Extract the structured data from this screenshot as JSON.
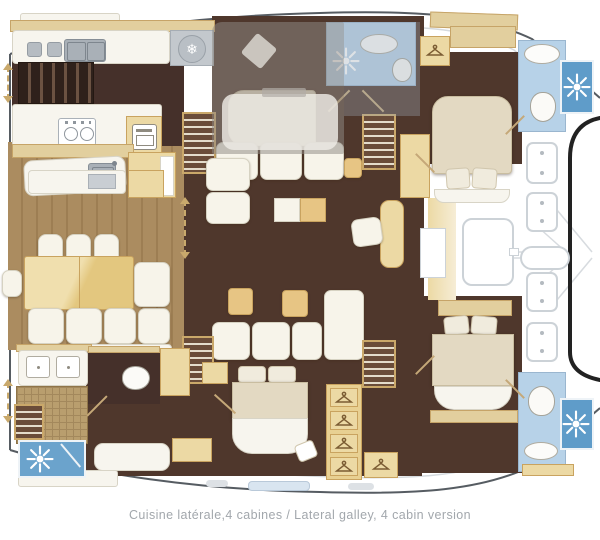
{
  "caption": {
    "text": "Cuisine latérale,4 cabines / Lateral galley, 4 cabin version"
  },
  "colors": {
    "hull_line": "#4a5055",
    "deck_line": "#c9ced3",
    "wood_floor": "#aa8b5e",
    "cabin_floor": "#4f372c",
    "cabinet_tan": "#ecd9a4",
    "bed_cream": "#e3d9c2",
    "white_furniture": "#f7f4ea",
    "bathroom_blue": "#b7d2e8",
    "shower_blue": "#5f9cc9",
    "flybridge_overlay_gray": "#8f8b85",
    "caption_text": "#a2a7ac"
  },
  "icons": {
    "fridge": {
      "name": "snowflake-icon",
      "glyph": "❄"
    },
    "shower": {
      "name": "sun-icon"
    },
    "wardrobe": {
      "name": "hanger-icon"
    },
    "hatch": {
      "name": "deck-hatch"
    },
    "stairs": {
      "name": "companionway-stairs"
    }
  }
}
